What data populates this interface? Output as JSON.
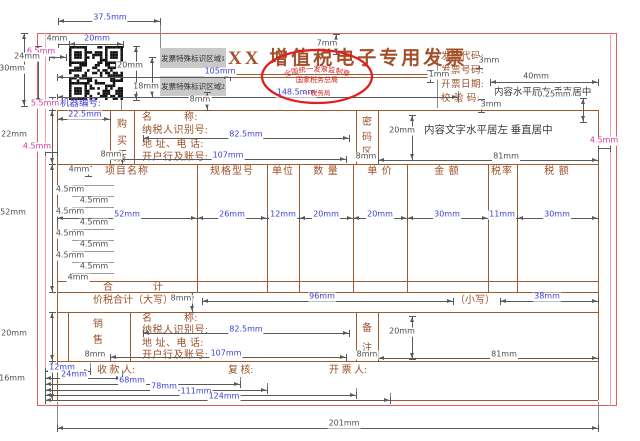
{
  "colors": {
    "paper_border_red": "#d96060",
    "margin_line_pink": "#eda3a3",
    "table_brown": "#a05a30",
    "label_brown": "#9c5129",
    "dim_blue": "#3a42d4",
    "dim_gray": "#4d4d4d",
    "dim_magenta": "#cf379c",
    "stamp_red": "#e01f1f"
  },
  "top": {
    "qr_code": "qr-code",
    "special_zones": [
      "发票特殊标识区域1",
      "发票特殊标识区域2"
    ],
    "machine_no_label": "机器编号:",
    "title": "XX 增值税电子专用发票",
    "stamp": {
      "arc_top": "全国统一发票监制章",
      "middle": "国家税务总局",
      "bottom": "××税务局"
    },
    "header_fields": [
      "发票代码:",
      "发票号码:",
      "开票日期:",
      "校 验 码:"
    ],
    "header_note": "内容水平居左 垂直居中"
  },
  "buyer": {
    "strip_chars": [
      "购",
      "买",
      "方"
    ],
    "fields": [
      "名　　　称:",
      "纳税人识别号:",
      "地 址、电 话:",
      "开户行及账号:"
    ]
  },
  "password_area": {
    "strip_chars": [
      "密",
      "码",
      "区"
    ],
    "note": "内容文字水平居左 垂直居中"
  },
  "items": {
    "headers": [
      "项目名称",
      "规格型号",
      "单位",
      "数 量",
      "单 价",
      "金 额",
      "税率",
      "税 额"
    ],
    "total_label": "合　　　　计"
  },
  "tax_total": {
    "label_upper": "价税合计（大写）",
    "label_lower": "（小写）"
  },
  "seller": {
    "strip_chars": [
      "销",
      "售",
      "方"
    ],
    "fields": [
      "名　　　称:",
      "纳税人识别号:",
      "地 址、电 话:",
      "开户行及账号:"
    ]
  },
  "notes_area": {
    "strip_chars": [
      "备",
      "注"
    ]
  },
  "footer": {
    "labels": [
      "收 款 人:",
      "复 核:",
      "开 票 人:"
    ]
  },
  "dims": [
    {
      "id": "d37",
      "label": "37.5mm",
      "c": "b"
    },
    {
      "id": "d4a",
      "label": "4mm",
      "c": "g"
    },
    {
      "id": "d20a",
      "label": "20mm",
      "c": "b"
    },
    {
      "id": "d65",
      "label": "6.5mm",
      "c": "m"
    },
    {
      "id": "d30",
      "label": "30mm",
      "c": "g"
    },
    {
      "id": "d24",
      "label": "24mm",
      "c": "g"
    },
    {
      "id": "d20b",
      "label": "20mm",
      "c": "g"
    },
    {
      "id": "d18",
      "label": "18mm",
      "c": "g"
    },
    {
      "id": "d8a",
      "label": "8mm",
      "c": "g"
    },
    {
      "id": "d105",
      "label": "105mm",
      "c": "b"
    },
    {
      "id": "d148",
      "label": "148.5mm",
      "c": "b"
    },
    {
      "id": "d7",
      "label": "7mm",
      "c": "g"
    },
    {
      "id": "d1",
      "label": "1mm",
      "c": "g"
    },
    {
      "id": "d3a",
      "label": "3mm",
      "c": "g"
    },
    {
      "id": "d3b",
      "label": "3mm",
      "c": "g"
    },
    {
      "id": "d40",
      "label": "40mm",
      "c": "g"
    },
    {
      "id": "d025",
      "label": "0.25mm",
      "c": "g"
    },
    {
      "id": "d55",
      "label": "5.5mm",
      "c": "m"
    },
    {
      "id": "d225",
      "label": "22.5mm",
      "c": "b"
    },
    {
      "id": "d45a",
      "label": "4.5mm",
      "c": "m"
    },
    {
      "id": "d8b",
      "label": "8mm",
      "c": "g"
    },
    {
      "id": "d82a",
      "label": "82.5mm",
      "c": "b"
    },
    {
      "id": "d107a",
      "label": "107mm",
      "c": "b"
    },
    {
      "id": "d20c",
      "label": "20mm",
      "c": "g"
    },
    {
      "id": "d45b",
      "label": "4.5mm",
      "c": "m"
    },
    {
      "id": "d8c",
      "label": "8mm",
      "c": "g"
    },
    {
      "id": "d22",
      "label": "22mm",
      "c": "g"
    },
    {
      "id": "d4c",
      "label": "4mm",
      "c": "g"
    },
    {
      "id": "r1",
      "label": "4.5mm",
      "c": "g"
    },
    {
      "id": "r2",
      "label": "4.5mm",
      "c": "g"
    },
    {
      "id": "r3",
      "label": "4.5mm",
      "c": "g"
    },
    {
      "id": "r4",
      "label": "4.5mm",
      "c": "g"
    },
    {
      "id": "r5",
      "label": "4.5mm",
      "c": "g"
    },
    {
      "id": "r6",
      "label": "4.5mm",
      "c": "g"
    },
    {
      "id": "r7",
      "label": "4.5mm",
      "c": "g"
    },
    {
      "id": "r8",
      "label": "4.5mm",
      "c": "g"
    },
    {
      "id": "d4d",
      "label": "4mm",
      "c": "g"
    },
    {
      "id": "c52",
      "label": "52mm",
      "c": "b"
    },
    {
      "id": "c26",
      "label": "26mm",
      "c": "b"
    },
    {
      "id": "c12",
      "label": "12mm",
      "c": "b"
    },
    {
      "id": "c20a",
      "label": "20mm",
      "c": "b"
    },
    {
      "id": "c20b",
      "label": "20mm",
      "c": "b"
    },
    {
      "id": "c30a",
      "label": "30mm",
      "c": "b"
    },
    {
      "id": "c11",
      "label": "11mm",
      "c": "b"
    },
    {
      "id": "c30b",
      "label": "30mm",
      "c": "b"
    },
    {
      "id": "d52",
      "label": "52mm",
      "c": "g"
    },
    {
      "id": "d8d",
      "label": "8mm",
      "c": "g"
    },
    {
      "id": "d96",
      "label": "96mm",
      "c": "b"
    },
    {
      "id": "d38",
      "label": "38mm",
      "c": "b"
    },
    {
      "id": "d82b",
      "label": "82.5mm",
      "c": "b"
    },
    {
      "id": "d107b",
      "label": "107mm",
      "c": "b"
    },
    {
      "id": "d8e",
      "label": "8mm",
      "c": "g"
    },
    {
      "id": "d20d",
      "label": "20mm",
      "c": "g"
    },
    {
      "id": "d8f",
      "label": "8mm",
      "c": "g"
    },
    {
      "id": "d81a",
      "label": "81mm",
      "c": "g"
    },
    {
      "id": "d81b",
      "label": "81mm",
      "c": "g"
    },
    {
      "id": "d20sl",
      "label": "20mm",
      "c": "g"
    },
    {
      "id": "d16",
      "label": "16mm",
      "c": "g"
    },
    {
      "id": "f12",
      "label": "12mm",
      "c": "b"
    },
    {
      "id": "f24",
      "label": "24mm",
      "c": "b"
    },
    {
      "id": "f68",
      "label": "68mm",
      "c": "b"
    },
    {
      "id": "f78",
      "label": "78mm",
      "c": "b"
    },
    {
      "id": "f111",
      "label": "111mm",
      "c": "b"
    },
    {
      "id": "f124",
      "label": "124mm",
      "c": "b"
    },
    {
      "id": "d201",
      "label": "201mm",
      "c": "g"
    }
  ]
}
